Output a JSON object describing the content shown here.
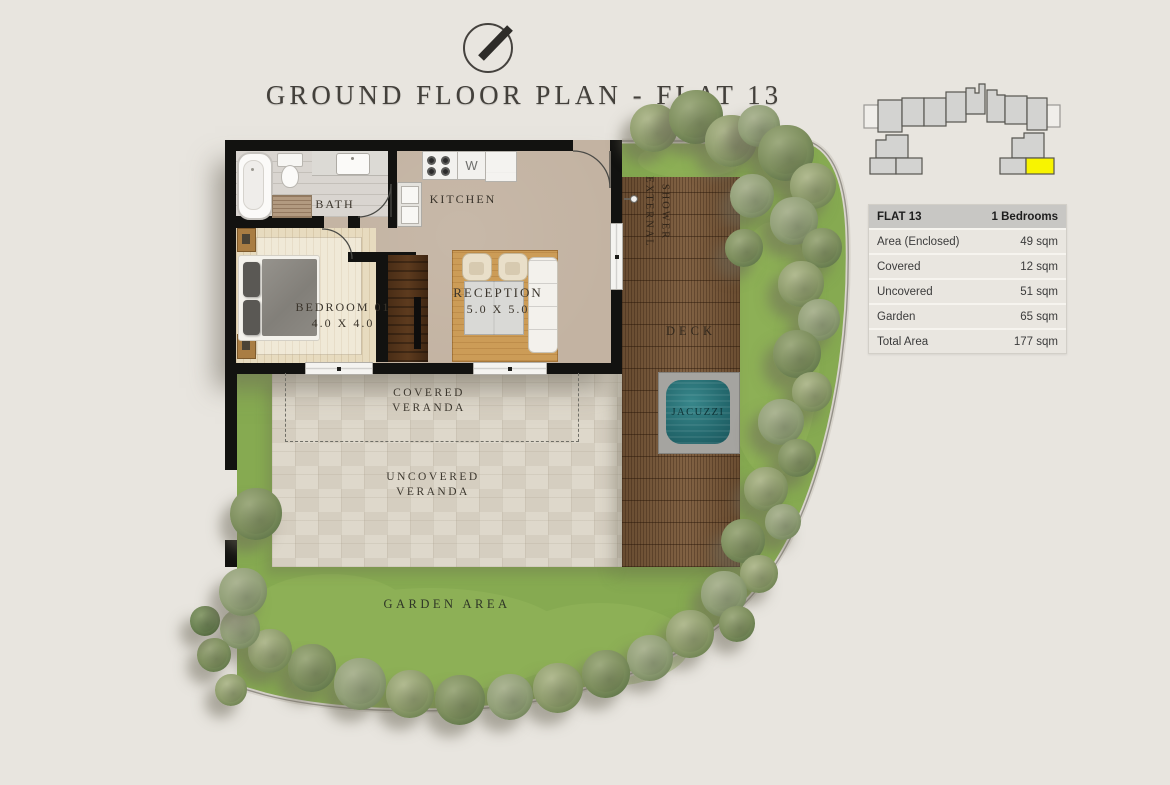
{
  "header": {
    "title": "GROUND FLOOR PLAN - FLAT 13",
    "compass_icon": "north-arrow-compass",
    "key_plan_icon": "building-key-plan"
  },
  "table": {
    "header": {
      "label": "FLAT 13",
      "value": "1 Bedrooms"
    },
    "rows": [
      {
        "label": "Area (Enclosed)",
        "value": "49 sqm"
      },
      {
        "label": "Covered",
        "value": "12 sqm"
      },
      {
        "label": "Uncovered",
        "value": "51 sqm"
      },
      {
        "label": "Garden",
        "value": "65 sqm"
      },
      {
        "label": "Total Area",
        "value": "177 sqm"
      }
    ]
  },
  "plan": {
    "bath": {
      "label": "BATH"
    },
    "kitchen": {
      "label": "KITCHEN",
      "washer_label": "W"
    },
    "bedroom": {
      "label": "BEDROOM 01",
      "dimensions": "4.0 X 4.0"
    },
    "reception": {
      "label": "RECEPTION",
      "dimensions": "5.0 X 5.0"
    },
    "external_shower": {
      "line1": "EXTERNAL",
      "line2": "SHOWER"
    },
    "deck": {
      "label": "DECK"
    },
    "jacuzzi": {
      "label": "JACUZZI"
    },
    "covered_veranda": {
      "line1": "COVERED",
      "line2": "VERANDA"
    },
    "uncovered_veranda": {
      "line1": "UNCOVERED",
      "line2": "VERANDA"
    },
    "garden": {
      "label": "GARDEN AREA"
    }
  },
  "colors": {
    "page_background": "#e8e5df",
    "wall": "#121210",
    "grass": "#86aa51",
    "deck_wood": "#7a5939",
    "jacuzzi_water": "#24696e",
    "key_plan_highlight": "#f8f400",
    "table_header_bg": "#c8c7c4",
    "table_row_bg": "#e9e6e0"
  }
}
